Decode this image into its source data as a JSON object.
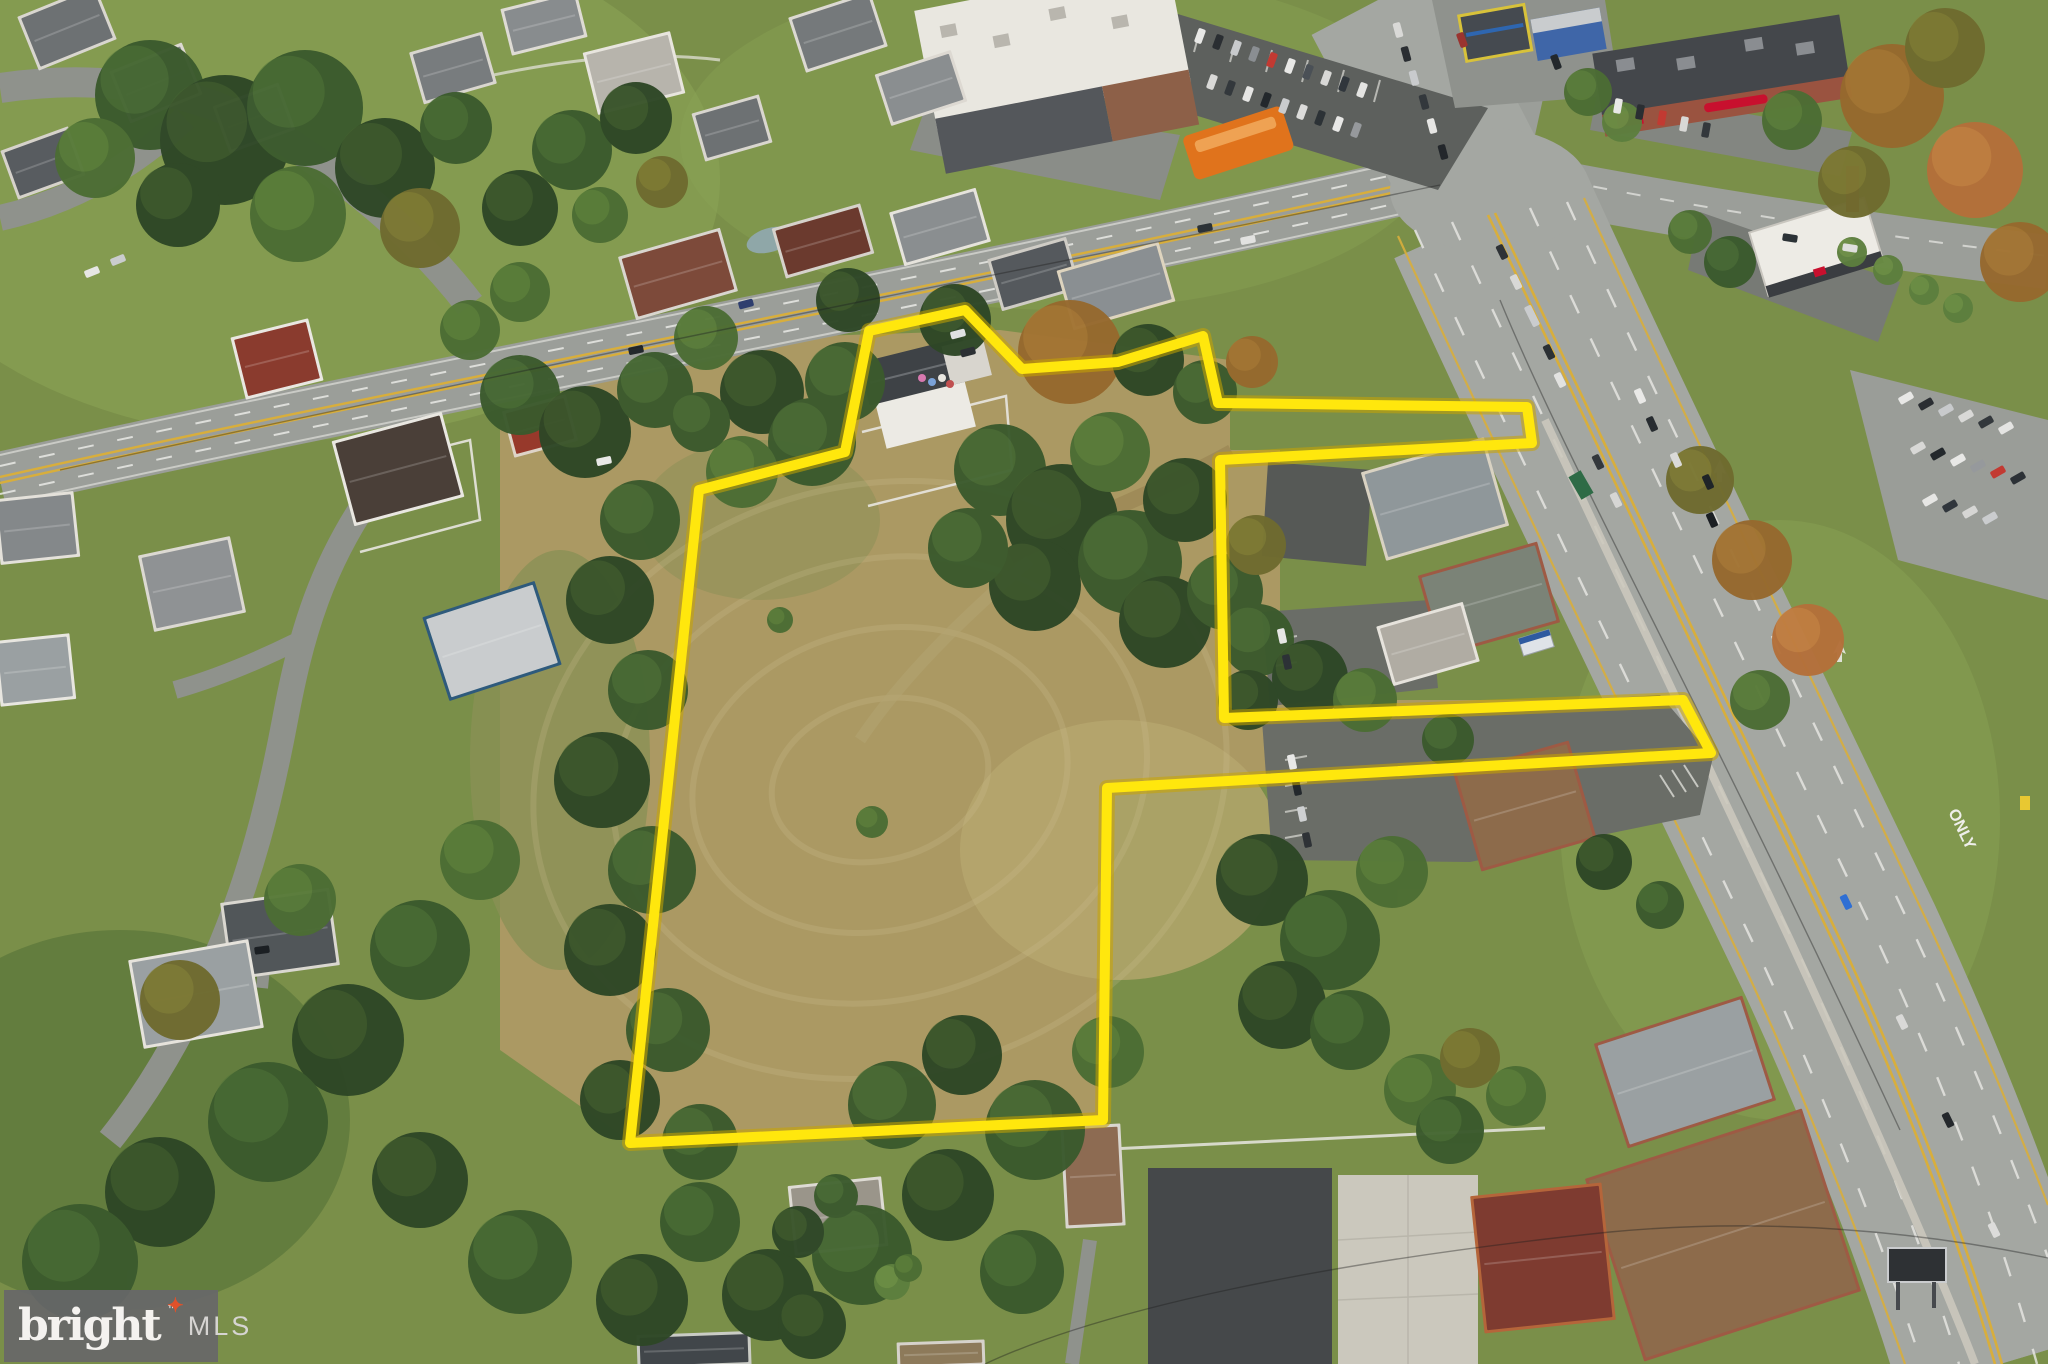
{
  "watermark": {
    "brand": "bright",
    "star": "✦",
    "tm": "™",
    "mls": "MLS",
    "bg_color": "rgba(103,103,105,0.92)",
    "brand_color": "#f4f2ef",
    "star_color": "#e0512a",
    "mls_color": "#d6d4d2"
  },
  "road_markings": {
    "only_label": "ONLY"
  },
  "parcel_outline": {
    "color": "#ffe70d",
    "glow_color": "#c9a400",
    "stroke_width": 10,
    "points": [
      [
        699,
        490
      ],
      [
        845,
        452
      ],
      [
        869,
        331
      ],
      [
        965,
        310
      ],
      [
        1022,
        369
      ],
      [
        1118,
        362
      ],
      [
        1203,
        336
      ],
      [
        1218,
        403
      ],
      [
        1527,
        407
      ],
      [
        1532,
        443
      ],
      [
        1220,
        460
      ],
      [
        1224,
        718
      ],
      [
        1683,
        700
      ],
      [
        1711,
        753
      ],
      [
        1107,
        788
      ],
      [
        1103,
        1120
      ],
      [
        630,
        1143
      ]
    ]
  },
  "palette": {
    "grass": "#7a8f49",
    "grass_light": "#8aa355",
    "grass_dark": "#5c773b",
    "field": "#ab9963",
    "field_light": "#b7a66e",
    "scrub": "#8a9055",
    "road": "#9b9e99",
    "highway": "#a4a7a2",
    "lot": "#5d605d",
    "lot_mid": "#6a6d67",
    "concrete": "#cbc8bd",
    "pad_dark": "#45484a",
    "center_yellow": "#d8ae3c",
    "lane_white": "#e9e9e5"
  },
  "trees": {
    "palette": {
      "t1": "#2e4726",
      "t2": "#3b5a2d",
      "t3": "#4c6d34",
      "t4": "#5d7f3e",
      "a1": "#6f6b2f",
      "a2": "#96692e",
      "a3": "#b4703a"
    },
    "highlight": {
      "t1": "#46632f",
      "t2": "#527539",
      "t3": "#648a3e",
      "t4": "#789a4a",
      "a1": "#8a8538",
      "a2": "#b08038",
      "a3": "#cb8a46"
    },
    "items": [
      [
        150,
        95,
        55,
        "t2"
      ],
      [
        225,
        140,
        65,
        "t1"
      ],
      [
        305,
        108,
        58,
        "t2"
      ],
      [
        385,
        168,
        50,
        "t1"
      ],
      [
        298,
        214,
        48,
        "t3"
      ],
      [
        178,
        205,
        42,
        "t1"
      ],
      [
        95,
        158,
        40,
        "t3"
      ],
      [
        420,
        228,
        40,
        "a1"
      ],
      [
        456,
        128,
        36,
        "t2"
      ],
      [
        520,
        208,
        38,
        "t1"
      ],
      [
        572,
        150,
        40,
        "t2"
      ],
      [
        636,
        118,
        36,
        "t1"
      ],
      [
        520,
        292,
        30,
        "t3"
      ],
      [
        600,
        215,
        28,
        "t3"
      ],
      [
        662,
        182,
        26,
        "a1"
      ],
      [
        470,
        330,
        30,
        "t3"
      ],
      [
        520,
        395,
        40,
        "t2"
      ],
      [
        585,
        432,
        46,
        "t1"
      ],
      [
        655,
        390,
        38,
        "t2"
      ],
      [
        706,
        338,
        32,
        "t3"
      ],
      [
        845,
        382,
        40,
        "t2"
      ],
      [
        955,
        320,
        36,
        "t1"
      ],
      [
        1070,
        352,
        52,
        "a2"
      ],
      [
        848,
        300,
        32,
        "t1"
      ],
      [
        762,
        392,
        42,
        "t1"
      ],
      [
        812,
        442,
        44,
        "t2"
      ],
      [
        742,
        472,
        36,
        "t3"
      ],
      [
        700,
        422,
        30,
        "t2"
      ],
      [
        640,
        520,
        40,
        "t2"
      ],
      [
        610,
        600,
        44,
        "t1"
      ],
      [
        648,
        690,
        40,
        "t2"
      ],
      [
        602,
        780,
        48,
        "t1"
      ],
      [
        652,
        870,
        44,
        "t2"
      ],
      [
        610,
        950,
        46,
        "t1"
      ],
      [
        668,
        1030,
        42,
        "t2"
      ],
      [
        620,
        1100,
        40,
        "t1"
      ],
      [
        700,
        1142,
        38,
        "t2"
      ],
      [
        480,
        860,
        40,
        "t3"
      ],
      [
        420,
        950,
        50,
        "t2"
      ],
      [
        348,
        1040,
        56,
        "t1"
      ],
      [
        268,
        1122,
        60,
        "t2"
      ],
      [
        160,
        1192,
        55,
        "t1"
      ],
      [
        80,
        1262,
        58,
        "t2"
      ],
      [
        420,
        1180,
        48,
        "t1"
      ],
      [
        520,
        1262,
        52,
        "t2"
      ],
      [
        642,
        1300,
        46,
        "t1"
      ],
      [
        300,
        900,
        36,
        "t3"
      ],
      [
        180,
        1000,
        40,
        "a1"
      ],
      [
        1000,
        470,
        46,
        "t2"
      ],
      [
        1062,
        520,
        56,
        "t1"
      ],
      [
        1130,
        562,
        52,
        "t2"
      ],
      [
        1185,
        500,
        42,
        "t1"
      ],
      [
        1110,
        452,
        40,
        "t3"
      ],
      [
        1035,
        585,
        46,
        "t1"
      ],
      [
        968,
        548,
        40,
        "t2"
      ],
      [
        1165,
        622,
        46,
        "t1"
      ],
      [
        1225,
        592,
        38,
        "t2"
      ],
      [
        1256,
        545,
        30,
        "a1"
      ],
      [
        1148,
        360,
        36,
        "t1"
      ],
      [
        1205,
        392,
        32,
        "t2"
      ],
      [
        1252,
        362,
        26,
        "a2"
      ],
      [
        1258,
        640,
        36,
        "t2"
      ],
      [
        1310,
        678,
        38,
        "t1"
      ],
      [
        1365,
        700,
        32,
        "t3"
      ],
      [
        1248,
        700,
        30,
        "t1"
      ],
      [
        1262,
        880,
        46,
        "t1"
      ],
      [
        1330,
        940,
        50,
        "t2"
      ],
      [
        1282,
        1005,
        44,
        "t1"
      ],
      [
        1392,
        872,
        36,
        "t3"
      ],
      [
        1350,
        1030,
        40,
        "t2"
      ],
      [
        1420,
        1090,
        36,
        "t3"
      ],
      [
        1470,
        1058,
        30,
        "a1"
      ],
      [
        892,
        1105,
        44,
        "t2"
      ],
      [
        962,
        1055,
        40,
        "t1"
      ],
      [
        1035,
        1130,
        50,
        "t2"
      ],
      [
        948,
        1195,
        46,
        "t1"
      ],
      [
        862,
        1255,
        50,
        "t2"
      ],
      [
        768,
        1295,
        46,
        "t1"
      ],
      [
        1022,
        1272,
        42,
        "t2"
      ],
      [
        1108,
        1052,
        36,
        "t3"
      ],
      [
        700,
        1222,
        40,
        "t2"
      ],
      [
        812,
        1325,
        34,
        "t1"
      ],
      [
        872,
        822,
        16,
        "t3"
      ],
      [
        780,
        620,
        13,
        "t3"
      ],
      [
        1892,
        96,
        52,
        "a2"
      ],
      [
        1975,
        170,
        48,
        "a3"
      ],
      [
        1945,
        48,
        40,
        "a1"
      ],
      [
        2020,
        262,
        40,
        "a2"
      ],
      [
        1854,
        182,
        36,
        "a1"
      ],
      [
        1792,
        120,
        30,
        "t3"
      ],
      [
        1852,
        252,
        15,
        "t4"
      ],
      [
        1888,
        270,
        15,
        "t4"
      ],
      [
        1924,
        290,
        15,
        "t4"
      ],
      [
        1958,
        308,
        15,
        "t4"
      ],
      [
        1752,
        560,
        40,
        "a2"
      ],
      [
        1700,
        480,
        34,
        "a1"
      ],
      [
        1808,
        640,
        36,
        "a3"
      ],
      [
        1760,
        700,
        30,
        "t3"
      ],
      [
        1730,
        262,
        26,
        "t2"
      ],
      [
        1690,
        232,
        22,
        "t3"
      ],
      [
        1588,
        92,
        24,
        "t3"
      ],
      [
        1622,
        122,
        20,
        "t4"
      ],
      [
        1450,
        1130,
        34,
        "t2"
      ],
      [
        1516,
        1096,
        30,
        "t3"
      ],
      [
        892,
        1282,
        18,
        "t4"
      ],
      [
        908,
        1268,
        14,
        "t3"
      ],
      [
        1448,
        740,
        26,
        "t2"
      ],
      [
        1604,
        862,
        28,
        "t1"
      ],
      [
        1660,
        905,
        24,
        "t2"
      ],
      [
        798,
        1232,
        26,
        "t1"
      ],
      [
        836,
        1196,
        22,
        "t2"
      ]
    ]
  },
  "houses": {
    "items": [
      [
        28,
        2,
        78,
        52,
        -22,
        "#6d7173",
        "#d9d6cf"
      ],
      [
        120,
        58,
        72,
        50,
        -22,
        "#7d8183",
        "#ddd9d2"
      ],
      [
        10,
        140,
        66,
        46,
        -20,
        "#585c60",
        "#d6d2cb"
      ],
      [
        222,
        96,
        64,
        44,
        -20,
        "#8a8e90",
        "#ddd9d2"
      ],
      [
        418,
        44,
        70,
        48,
        -16,
        "#787c7e",
        "#d9d6cf"
      ],
      [
        508,
        2,
        72,
        42,
        -14,
        "#888c8e",
        "#dedbd4"
      ],
      [
        592,
        44,
        84,
        58,
        -14,
        "#b7b4ac",
        "#e8e5de"
      ],
      [
        700,
        106,
        64,
        44,
        -16,
        "#6d7173",
        "#d9d6cf"
      ],
      [
        798,
        6,
        80,
        52,
        -18,
        "#75797b",
        "#dcd9d2"
      ],
      [
        884,
        64,
        74,
        48,
        -18,
        "#8a8e90",
        "#ddd9d2"
      ],
      [
        628,
        244,
        100,
        60,
        -16,
        "#7d4a3a",
        "#d9d6cf"
      ],
      [
        780,
        218,
        86,
        46,
        -16,
        "#6b3a2e",
        "#d6d2cb"
      ],
      [
        898,
        202,
        84,
        50,
        -16,
        "#8a8e90",
        "#e6e3dc"
      ],
      [
        996,
        250,
        76,
        48,
        -16,
        "#55595d",
        "#cfccc5"
      ],
      [
        1066,
        258,
        100,
        56,
        -16,
        "#8a8f92",
        "#ded4be"
      ],
      [
        240,
        330,
        74,
        58,
        -14,
        "#8a3b2e",
        "#e9e7e1"
      ],
      [
        510,
        405,
        60,
        42,
        -15,
        "#97392b",
        "#ded4c8"
      ],
      [
        344,
        428,
        108,
        82,
        -15,
        "#4a3f38",
        "#e9e7e1"
      ],
      [
        436,
        600,
        112,
        82,
        -18,
        "#c9ccce",
        "#2e5a7c"
      ],
      [
        148,
        548,
        88,
        72,
        -12,
        "#8f9294",
        "#dcd9d2"
      ],
      [
        0,
        640,
        70,
        60,
        -6,
        "#9aa0a2",
        "#e8e6e0"
      ],
      [
        0,
        498,
        74,
        60,
        -6,
        "#84888a",
        "#e4e1da"
      ],
      [
        228,
        898,
        104,
        72,
        -8,
        "#515659",
        "#dad7d0"
      ],
      [
        138,
        952,
        116,
        84,
        -10,
        "#9aa0a2",
        "#e6e3dc"
      ],
      [
        1374,
        456,
        122,
        86,
        -16,
        "#8f979a",
        "#d9d2c2"
      ],
      [
        1430,
        560,
        118,
        78,
        -16,
        "#7b8377",
        "#9e5a44"
      ],
      [
        1386,
        616,
        84,
        56,
        -16,
        "#b0aca3",
        "#e6e3dc"
      ],
      [
        1468,
        758,
        114,
        96,
        -16,
        "#8d6b4b",
        "#9e5a44"
      ],
      [
        1066,
        1128,
        54,
        96,
        -3,
        "#8d6b52",
        "#d9d6cf"
      ],
      [
        1610,
        1020,
        150,
        104,
        -18,
        "#9aa0a2",
        "#9e5a44"
      ],
      [
        1612,
        1142,
        222,
        186,
        -18,
        "#8d6b4b",
        "#9e5a44"
      ],
      [
        1480,
        1192,
        126,
        132,
        -6,
        "#7e3b30",
        "#b5653a"
      ],
      [
        794,
        1184,
        88,
        64,
        -6,
        "#9a958a",
        "#dedbd4"
      ],
      [
        640,
        1336,
        108,
        28,
        -2,
        "#41464a",
        "#caccc5"
      ],
      [
        900,
        1344,
        82,
        20,
        -2,
        "#8d7a5a",
        "#d6d2cb"
      ]
    ]
  },
  "vehicles": {
    "items": [
      [
        1640,
        396,
        66,
        "#e9e9e7"
      ],
      [
        1652,
        424,
        66,
        "#272c30"
      ],
      [
        1676,
        460,
        66,
        "#dadad8"
      ],
      [
        1708,
        482,
        66,
        "#1f2428"
      ],
      [
        1712,
        520,
        66,
        "#1b1f23"
      ],
      [
        1398,
        30,
        75,
        "#d9d9d7"
      ],
      [
        1406,
        54,
        75,
        "#2a2e32"
      ],
      [
        1414,
        78,
        75,
        "#c9cbcd"
      ],
      [
        1424,
        102,
        75,
        "#33383c"
      ],
      [
        1432,
        126,
        75,
        "#e6e6e4"
      ],
      [
        1443,
        152,
        75,
        "#23272b"
      ],
      [
        1502,
        252,
        64,
        "#2e3236"
      ],
      [
        1516,
        282,
        64,
        "#d8d8d6"
      ],
      [
        1532,
        316,
        64,
        "#caccce",
        22
      ],
      [
        1549,
        352,
        64,
        "#2b3034"
      ],
      [
        1560,
        380,
        64,
        "#e2e2e0"
      ],
      [
        1598,
        462,
        64,
        "#33383c"
      ],
      [
        1616,
        500,
        64,
        "#d6d6d4"
      ],
      [
        1846,
        902,
        64,
        "#2f6fd4"
      ],
      [
        1902,
        1022,
        64,
        "#d9d9d7"
      ],
      [
        1948,
        1120,
        64,
        "#24282c"
      ],
      [
        1994,
        1230,
        64,
        "#dcdcda"
      ],
      [
        1906,
        398,
        150,
        "#e8e8e6"
      ],
      [
        1926,
        404,
        150,
        "#2a2e32"
      ],
      [
        1946,
        410,
        150,
        "#c8cacc"
      ],
      [
        1966,
        416,
        150,
        "#d9d9d7"
      ],
      [
        1986,
        422,
        150,
        "#33383c"
      ],
      [
        2006,
        428,
        150,
        "#e4e4e2"
      ],
      [
        1918,
        448,
        150,
        "#d8d8d6"
      ],
      [
        1938,
        454,
        150,
        "#23282c"
      ],
      [
        1958,
        460,
        150,
        "#e8e8e6"
      ],
      [
        1978,
        466,
        150,
        "#96999c"
      ],
      [
        1998,
        472,
        150,
        "#c23a32"
      ],
      [
        2018,
        478,
        150,
        "#2c3136"
      ],
      [
        1930,
        500,
        150,
        "#e6e6e4"
      ],
      [
        1950,
        506,
        150,
        "#30363c"
      ],
      [
        1970,
        512,
        150,
        "#d6d6d4"
      ],
      [
        1990,
        518,
        150,
        "#caccce"
      ],
      [
        636,
        350,
        -12,
        "#23282c"
      ],
      [
        604,
        461,
        -12,
        "#e8e8e6"
      ],
      [
        1205,
        228,
        -11,
        "#2c3236"
      ],
      [
        1248,
        240,
        -11,
        "#e2e2e0"
      ],
      [
        92,
        272,
        -22,
        "#e6e6e4"
      ],
      [
        118,
        260,
        -22,
        "#caccce"
      ],
      [
        262,
        950,
        -8,
        "#1b1f23"
      ],
      [
        958,
        334,
        -15,
        "#dfe1e2"
      ],
      [
        968,
        352,
        -15,
        "#2c3034"
      ],
      [
        746,
        304,
        -15,
        "#2e3e6e"
      ],
      [
        1200,
        36,
        110,
        "#e8e8e6"
      ],
      [
        1218,
        42,
        110,
        "#2a2e32"
      ],
      [
        1236,
        48,
        110,
        "#c8cacc"
      ],
      [
        1254,
        54,
        110,
        "#8a8e92"
      ],
      [
        1272,
        60,
        110,
        "#c23a32"
      ],
      [
        1290,
        66,
        110,
        "#e8e8e6"
      ],
      [
        1308,
        72,
        110,
        "#4a5056"
      ],
      [
        1326,
        78,
        110,
        "#d8d8d6"
      ],
      [
        1344,
        84,
        110,
        "#30363c"
      ],
      [
        1362,
        90,
        110,
        "#e4e4e2"
      ],
      [
        1212,
        82,
        110,
        "#d9d9d7"
      ],
      [
        1230,
        88,
        110,
        "#33383c"
      ],
      [
        1248,
        94,
        110,
        "#e6e6e4"
      ],
      [
        1266,
        100,
        110,
        "#23282c"
      ],
      [
        1284,
        106,
        110,
        "#caccce"
      ],
      [
        1302,
        112,
        110,
        "#dcdcda"
      ],
      [
        1320,
        118,
        110,
        "#2c3236"
      ],
      [
        1338,
        124,
        110,
        "#e8e8e6"
      ],
      [
        1356,
        130,
        110,
        "#96999c"
      ],
      [
        1618,
        106,
        100,
        "#e8e8e6"
      ],
      [
        1640,
        112,
        100,
        "#2a2e32"
      ],
      [
        1662,
        118,
        100,
        "#c23a32"
      ],
      [
        1684,
        124,
        100,
        "#d8d8d6"
      ],
      [
        1706,
        130,
        100,
        "#33383c"
      ],
      [
        1292,
        762,
        78,
        "#e8e8e6"
      ],
      [
        1297,
        788,
        78,
        "#23282c"
      ],
      [
        1302,
        814,
        78,
        "#cfd1d2"
      ],
      [
        1307,
        840,
        78,
        "#2e3236"
      ],
      [
        1282,
        636,
        78,
        "#e6e6e4"
      ],
      [
        1287,
        662,
        78,
        "#2c3136"
      ],
      [
        1462,
        40,
        70,
        "#9a3430"
      ],
      [
        1556,
        62,
        70,
        "#23282c"
      ],
      [
        1790,
        238,
        9,
        "#2c3236"
      ],
      [
        1850,
        248,
        9,
        "#dfdfdd"
      ]
    ]
  }
}
